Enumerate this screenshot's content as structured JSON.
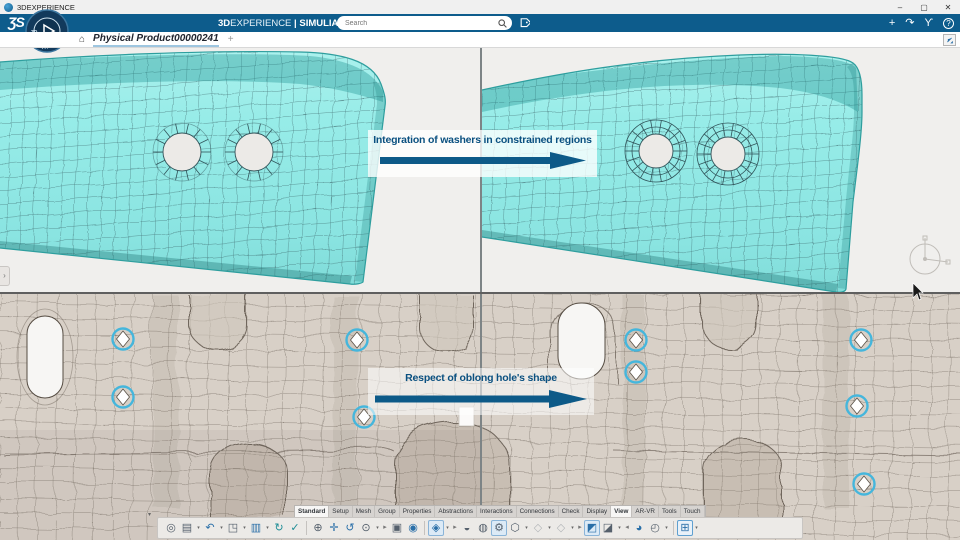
{
  "window": {
    "title": "3DEXPERIENCE",
    "minimize": "–",
    "maximize": "▢",
    "close": "✕"
  },
  "app_bar": {
    "logo": "ƷS",
    "compass_top": "3D",
    "compass_bottom": "V.R",
    "brand_bold": "3D",
    "brand_light": "EXPERIENCE",
    "divider": "|",
    "product_bold": "SIMULIA",
    "product_rest": "Structural Model Creation",
    "search_placeholder": "Search",
    "icons": [
      {
        "name": "add-content",
        "glyph": "+"
      },
      {
        "name": "share",
        "glyph": "↷"
      },
      {
        "name": "3ds-community",
        "glyph": "ϒ"
      },
      {
        "name": "help",
        "glyph": "?"
      }
    ]
  },
  "tab_bar": {
    "home": "⌂",
    "active_tab": "Physical Product00000241",
    "new_tab": "+"
  },
  "viewport": {
    "annotation_top": "Integration of washers in constrained regions",
    "annotation_bottom": "Respect of oblong hole's shape",
    "left_expander": "›",
    "colors": {
      "top_mesh_fill": "#8fe8e4",
      "top_mesh_dark": "#4cc6c3",
      "top_mesh_line": "#31545a",
      "bottom_mesh_fill": "#d8d0c7",
      "bottom_mesh_line": "#70675d",
      "hole_ring": "#45b6dc",
      "viewport_bg": "#f0efed",
      "annotation_text": "#0a5080",
      "annotation_arrow": "#0d5a88"
    }
  },
  "action_bar": {
    "caret": "▾",
    "overflow_chevron": "▾",
    "active_tabs": [
      "Standard",
      "View"
    ],
    "tabs": [
      "Standard",
      "Setup",
      "Mesh",
      "Group",
      "Properties",
      "Abstractions",
      "Interactions",
      "Connections",
      "Check",
      "Display",
      "View",
      "AR-VR",
      "Tools",
      "Touch"
    ],
    "icons": [
      {
        "name": "zoom-area",
        "glyph": "◎"
      },
      {
        "name": "model-browser",
        "glyph": "▤"
      },
      {
        "name": "undo",
        "glyph": "↶"
      },
      {
        "name": "manipulators",
        "glyph": "◳"
      },
      {
        "name": "work-supports",
        "glyph": "▥"
      },
      {
        "name": "update",
        "glyph": "↻"
      },
      {
        "name": "simulation-checks",
        "glyph": "✓"
      },
      {
        "name": "zoom-in-out",
        "glyph": "⊕"
      },
      {
        "name": "pan",
        "glyph": "✛"
      },
      {
        "name": "rotate",
        "glyph": "↺"
      },
      {
        "name": "zoom-options",
        "glyph": "⊙"
      },
      {
        "name": "view-flyout",
        "glyph": "▸"
      },
      {
        "name": "capture",
        "glyph": "▣"
      },
      {
        "name": "center-view",
        "glyph": "◉"
      },
      {
        "name": "shaded-view",
        "glyph": "◈"
      },
      {
        "name": "render-flyout",
        "glyph": "▸"
      },
      {
        "name": "section-view",
        "glyph": "◒"
      },
      {
        "name": "ground-context",
        "glyph": "◍"
      },
      {
        "name": "mechanical-features",
        "glyph": "⚙"
      },
      {
        "name": "fastener-display",
        "glyph": "⬡"
      },
      {
        "name": "display-option-a",
        "glyph": "◇"
      },
      {
        "name": "display-option-b",
        "glyph": "◇"
      },
      {
        "name": "display-flyout",
        "glyph": "▸"
      },
      {
        "name": "select-mode",
        "glyph": "◩"
      },
      {
        "name": "hide-show",
        "glyph": "◪"
      },
      {
        "name": "previous-view",
        "glyph": "◂"
      },
      {
        "name": "visibility-tools",
        "glyph": "◕"
      },
      {
        "name": "turntable",
        "glyph": "◴"
      },
      {
        "name": "quad-view",
        "glyph": "⊞"
      }
    ]
  }
}
